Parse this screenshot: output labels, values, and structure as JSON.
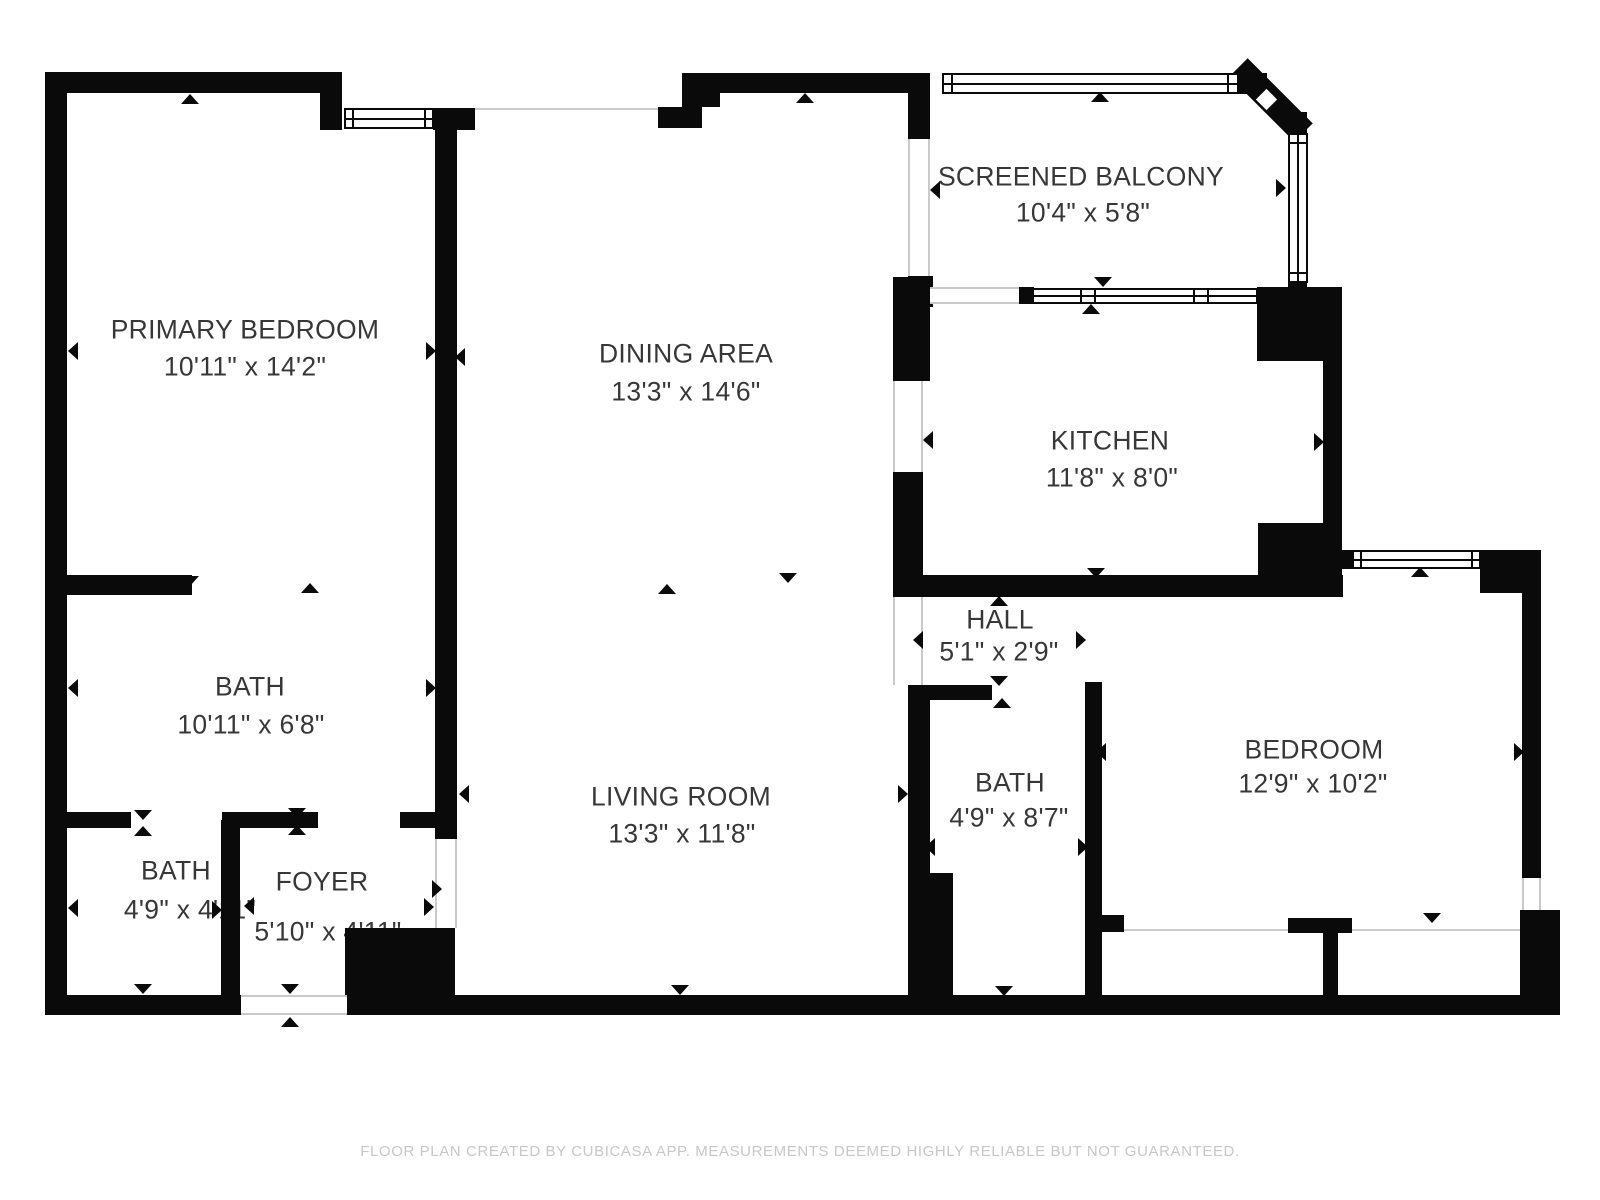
{
  "rooms": {
    "primary_bedroom": {
      "name": "PRIMARY BEDROOM",
      "dims": "10'11\" x 14'2\""
    },
    "dining_area": {
      "name": "DINING AREA",
      "dims": "13'3\" x 14'6\""
    },
    "screened_balcony": {
      "name": "SCREENED BALCONY",
      "dims": "10'4\" x 5'8\""
    },
    "kitchen": {
      "name": "KITCHEN",
      "dims": "11'8\" x 8'0\""
    },
    "hall": {
      "name": "HALL",
      "dims": "5'1\" x 2'9\""
    },
    "bath_main": {
      "name": "BATH",
      "dims": "10'11\" x 6'8\""
    },
    "living_room": {
      "name": "LIVING ROOM",
      "dims": "13'3\" x 11'8\""
    },
    "bath_hall": {
      "name": "BATH",
      "dims": "4'9\" x 8'7\""
    },
    "bedroom": {
      "name": "BEDROOM",
      "dims": "12'9\" x 10'2\""
    },
    "bath_small": {
      "name": "BATH",
      "dims": "4'9\" x 4'11\""
    },
    "foyer": {
      "name": "FOYER",
      "dims": "5'10\" x 4'11\""
    }
  },
  "footer": {
    "text": "FLOOR PLAN CREATED BY CUBICASA APP. MEASUREMENTS DEEMED HIGHLY RELIABLE BUT NOT GUARANTEED."
  },
  "colors": {
    "wall": "#0a0a0a",
    "text": "#373737",
    "footer_text": "#c7c7c7",
    "thin_line": "#cccccc",
    "background": "#ffffff"
  }
}
